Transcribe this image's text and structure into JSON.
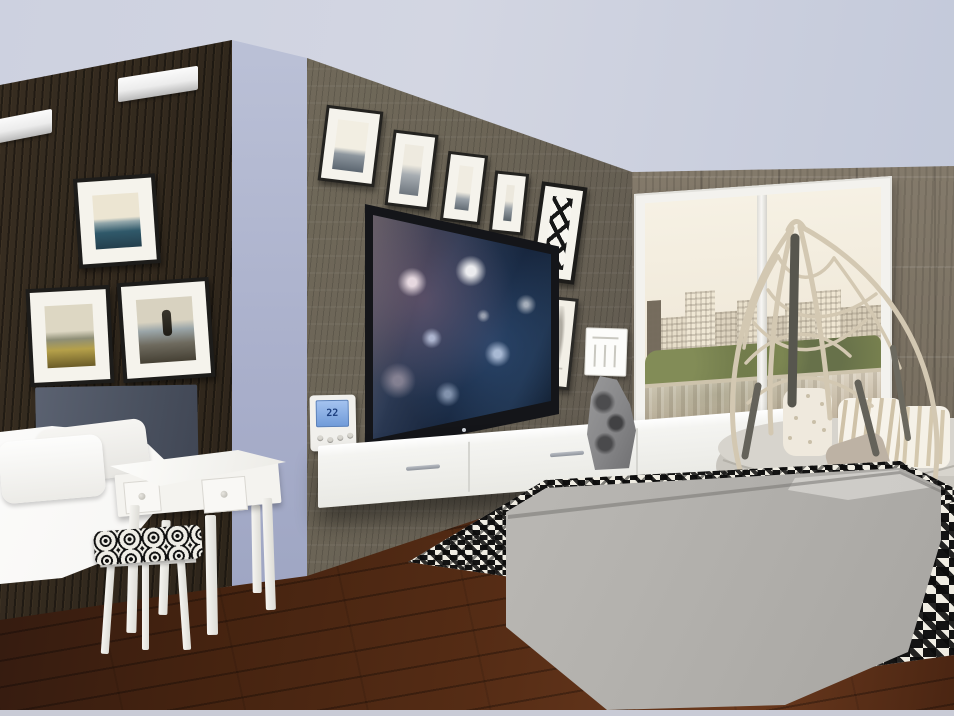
{
  "meta": {
    "type": "3d-interior-render",
    "room": "open-plan bedroom and living room",
    "window_view": "city skyline with trees and lake reflection"
  },
  "palette": {
    "ceiling": "#cdd1e0",
    "wall_dark_wood": "#2a2218",
    "wall_accent_periwinkle": "#a8aeca",
    "wall_tv_taupe": "#6b6456",
    "wall_right_taupe": "#7b7263",
    "floor_wood": "#552c15",
    "console_white": "#f4f4f1",
    "sofa_gray": "#b4b2ae",
    "rug_black": "#131313",
    "rug_white": "#efece2",
    "chair_frame_beige": "#d3c8b2",
    "tv_screen_navy": "#0e1826",
    "thermostat_screen_blue": "#6f9ad8"
  },
  "thermostat": {
    "display": "22"
  },
  "artwork": {
    "left_wall": [
      "seaside pier photo",
      "beach dunes photo",
      "stone cairn photo"
    ],
    "above_tv": [
      "b&w seascape 1",
      "b&w seascape 2",
      "b&w seascape 3",
      "b&w seascape 4"
    ],
    "beside_tv": [
      "black abstract lattice print",
      "botanical sketch print"
    ]
  },
  "objects": [
    "ceiling bar lights",
    "bed with gray headboard",
    "white vanity desk",
    "stool with patterned cushion",
    "wall thermostat",
    "flat screen tv",
    "floating media console",
    "gray stone sculpture",
    "hanging egg chair",
    "gray daybed bench",
    "striped pillows",
    "houndstooth rug",
    "gray sofa",
    "floor-to-ceiling window"
  ]
}
